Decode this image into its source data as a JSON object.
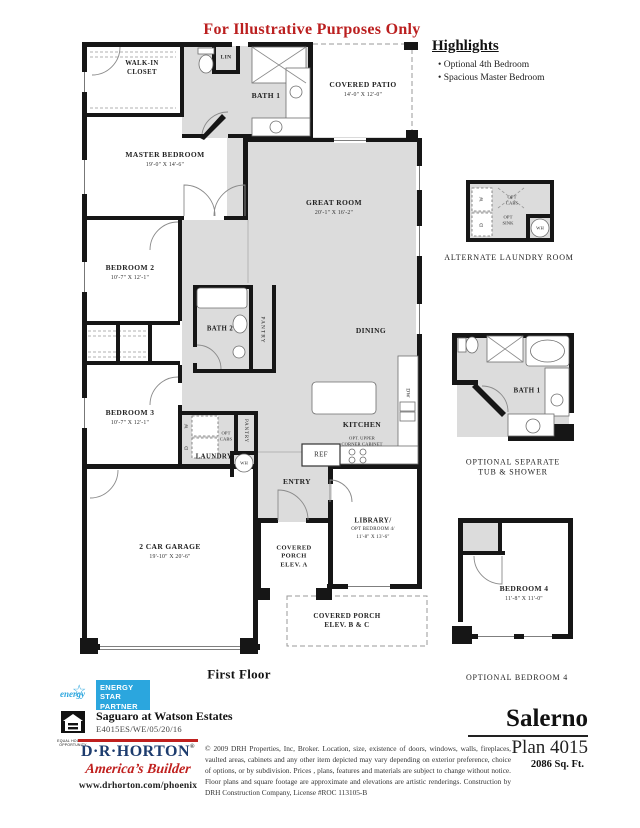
{
  "page": {
    "disclaimer": "For Illustrative Purposes Only",
    "first_floor": "First Floor"
  },
  "highlights": {
    "title": "Highlights",
    "items": [
      "Optional 4th Bedroom",
      "Spacious Master Bedroom"
    ]
  },
  "plan": {
    "walk_in_closet": "WALK-IN\nCLOSET",
    "lin": "LIN",
    "bath1": "BATH 1",
    "covered_patio": "COVERED PATIO",
    "covered_patio_dims": "14'-0\" X 12'-0\"",
    "master_bedroom": "MASTER BEDROOM",
    "master_bedroom_dims": "19'-0\" X 14'-6\"",
    "great_room": "GREAT ROOM",
    "great_room_dims": "20'-1\" X 16'-2\"",
    "bedroom2": "BEDROOM 2",
    "bedroom2_dims": "10'-7\" X 12'-1\"",
    "bath2": "BATH 2",
    "pantry": "PANTRY",
    "dining": "DINING",
    "bedroom3": "BEDROOM 3",
    "bedroom3_dims": "10'-7\" X 12'-1\"",
    "laundry": "LAUNDRY",
    "opt_cabs": "OPT\nCABS",
    "w": "W",
    "d": "D",
    "wh": "WH",
    "kitchen": "KITCHEN",
    "opt_corner_cabinet": "OPT. UPPER\nCORNER CABINET",
    "ref": "REF",
    "dw": "DW",
    "entry": "ENTRY",
    "garage": "2 CAR GARAGE",
    "garage_dims": "19'-10\" X 20'-6\"",
    "covered_porch_a": "COVERED\nPORCH\nELEV. A",
    "library": "LIBRARY/",
    "library_opt": "OPT BEDROOM 4/",
    "library_dims": "11'-8\" X 13'-6\"",
    "covered_porch_bc": "COVERED PORCH\nELEV. B & C"
  },
  "inserts": {
    "alt_laundry": {
      "caption": "ALTERNATE LAUNDRY ROOM",
      "opt_cabs": "OPT\nCABS",
      "opt_sink": "OPT\nSINK",
      "w": "W",
      "d": "D",
      "wh": "WH"
    },
    "opt_bath": {
      "room": "BATH 1",
      "caption": "OPTIONAL SEPARATE\nTUB & SHOWER"
    },
    "opt_bedroom4": {
      "room": "BEDROOM 4",
      "dims": "11'-8\" X 11'-0\"",
      "caption": "OPTIONAL BEDROOM 4"
    }
  },
  "footer": {
    "energy_star": {
      "brand": "energy",
      "star": "☆",
      "lines": [
        "ENERGY",
        "STAR",
        "PARTNER"
      ]
    },
    "equal_housing": "EQUAL HOUSING\nOPPORTUNITY",
    "community": "Saguaro at Watson Estates",
    "community_code": "E4015ES/WE/05/20/16",
    "builder": {
      "name": "D·R·HORTON",
      "reg": "®",
      "tagline": "America’s Builder",
      "url": "www.drhorton.com/phoenix"
    },
    "legal": "© 2009 DRH  Properties, Inc, Broker. Location, size, existence of doors, windows, walls, fireplaces, vaulted areas, cabinets and any other item depicted may vary depending on exterior preference, choice of options, or by subdivision. Prices , plans, features and materials are subject to change without notice. Floor plans and square footage are approximate and elevations are artistic renderings. Construction by DRH Construction Company, License #ROC 113105-B",
    "plan_name": "Salerno",
    "plan_number": "Plan 4015",
    "sqft": "2086 Sq. Ft."
  },
  "colors": {
    "red": "#c0201e",
    "navy": "#1d3c6e",
    "room_gray": "#dcdcdc",
    "wall": "#161616",
    "energy_blue": "#2ba6de"
  }
}
